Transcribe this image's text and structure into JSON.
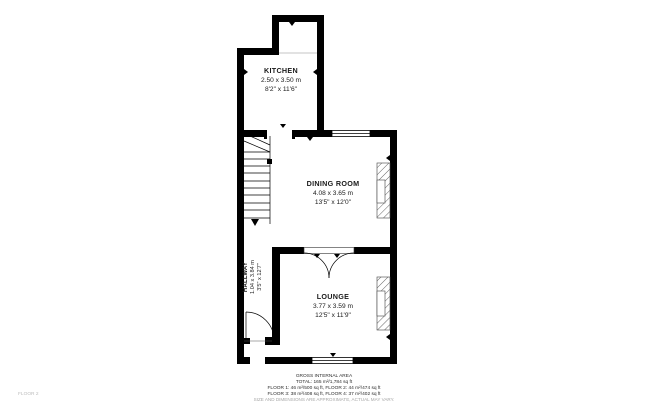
{
  "floor_label": "FLOOR 2",
  "rooms": [
    {
      "name": "KITCHEN",
      "metric": "2.50 x 3.50 m",
      "imperial": "8'2\" x 11'6\""
    },
    {
      "name": "DINING ROOM",
      "metric": "4.08 x 3.65 m",
      "imperial": "13'5\" x 12'0\""
    },
    {
      "name": "HALLWAY",
      "metric": "1.04 x 3.84 m",
      "imperial": "3'5\" x 12'7\""
    },
    {
      "name": "LOUNGE",
      "metric": "3.77 x 3.59 m",
      "imperial": "12'5\" x 11'9\""
    }
  ],
  "footer": {
    "title": "GROSS INTERNAL AREA",
    "total": "TOTAL: 165 m²/1,784 sq ft",
    "floors_a": "FLOOR 1: 46 m²/500 sq ft, FLOOR 2: 44 m²/474 sq ft",
    "floors_b": "FLOOR 3: 38 m²/408 sq ft, FLOOR 4: 37 m²/402 sq ft",
    "disclaimer": "SIZE AND DIMENSIONS ARE APPROXIMATE, ACTUAL MAY VARY."
  },
  "colors": {
    "wall": "#000000",
    "hatch": "#666666",
    "muted_text": "#a6a6a6",
    "faint_text": "#bdbdbd",
    "background": "#ffffff"
  }
}
